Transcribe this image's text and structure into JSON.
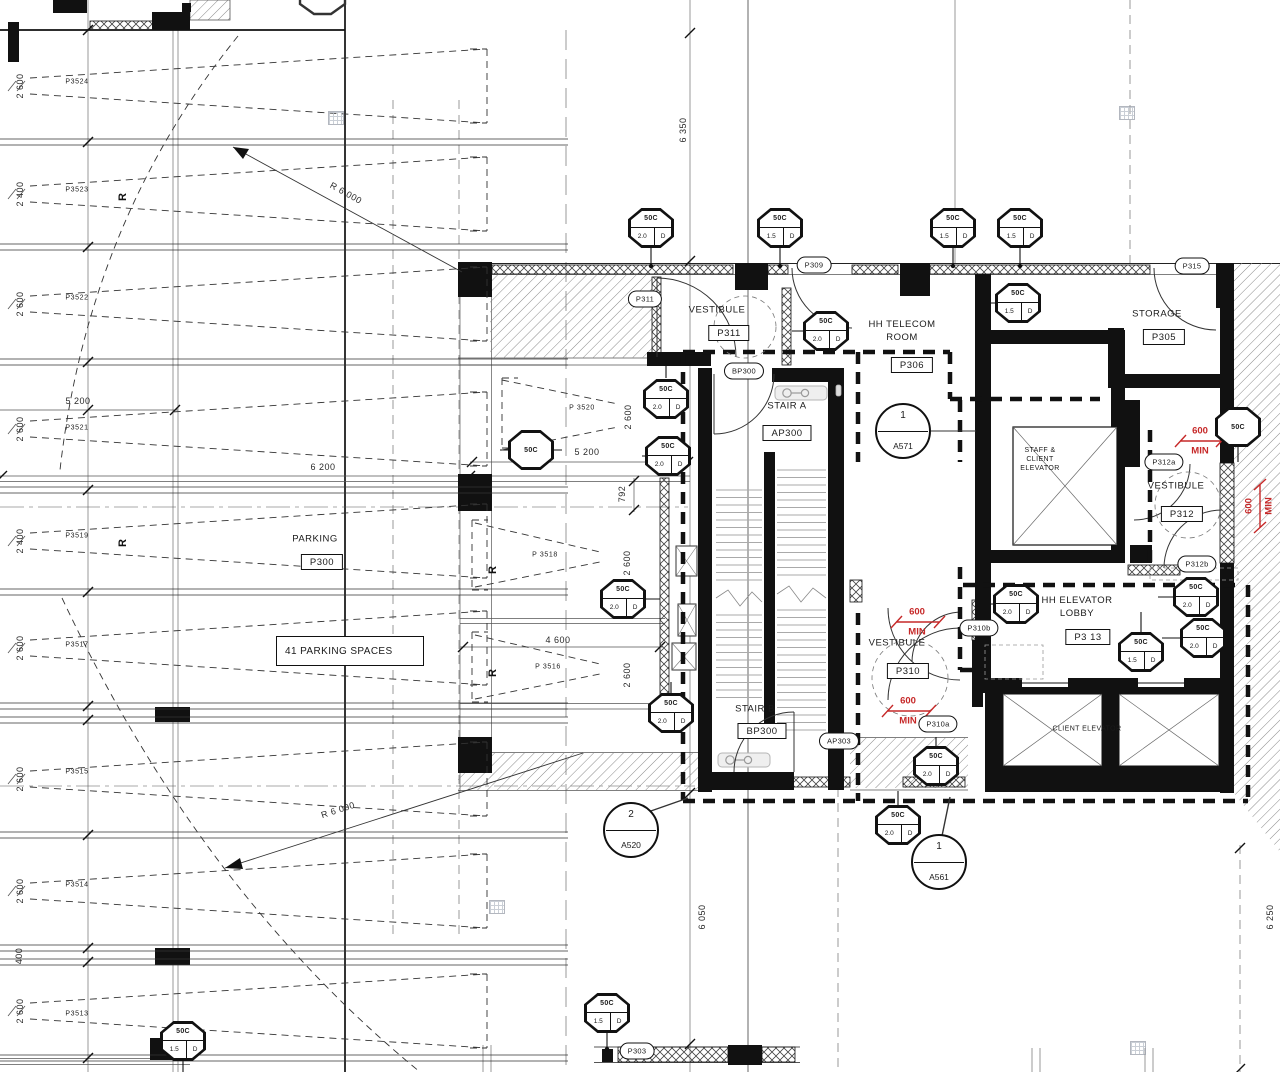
{
  "drawing": {
    "type": "parking-level-floor-plan",
    "red_accent": "#c62828"
  },
  "note": {
    "text": "41 PARKING SPACES"
  },
  "stalls": [
    {
      "label": "P3524",
      "dim": "2 600",
      "lx": 77,
      "ly": 82,
      "dx": 20,
      "dy": 86
    },
    {
      "label": "P3523",
      "dim": "2 400",
      "lx": 77,
      "ly": 190,
      "dx": 20,
      "dy": 194
    },
    {
      "label": "P3522",
      "dim": "2 600",
      "lx": 77,
      "ly": 298,
      "dx": 20,
      "dy": 304
    },
    {
      "label": "P3521",
      "dim": "2 600",
      "lx": 77,
      "ly": 428,
      "dx": 20,
      "dy": 429
    },
    {
      "label": "P3519",
      "dim": "2 400",
      "lx": 77,
      "ly": 536,
      "dx": 20,
      "dy": 541
    },
    {
      "label": "P3517",
      "dim": "2 600",
      "lx": 77,
      "ly": 645,
      "dx": 20,
      "dy": 648
    },
    {
      "label": "P3515",
      "dim": "2 600",
      "lx": 77,
      "ly": 772,
      "dx": 20,
      "dy": 779
    },
    {
      "label": "P3514",
      "dim": "2 600",
      "lx": 77,
      "ly": 885,
      "dx": 20,
      "dy": 891
    },
    {
      "label": "P3513",
      "dim": "2 600",
      "lx": 77,
      "ly": 1014,
      "dx": 20,
      "dy": 1011
    },
    {
      "label": "P 3520",
      "dim": "2 600",
      "lx": 582,
      "ly": 408,
      "dx": 628,
      "dy": 417
    },
    {
      "label": "P 3518",
      "dim": "2 600",
      "lx": 545,
      "ly": 555,
      "dx": 627,
      "dy": 563
    },
    {
      "label": "P 3516",
      "dim": "2 600",
      "lx": 548,
      "ly": 667,
      "dx": 627,
      "dy": 675
    }
  ],
  "dims": [
    {
      "t": "5 200",
      "x": 78,
      "y": 401,
      "r": 0
    },
    {
      "t": "6 200",
      "x": 323,
      "y": 467,
      "r": 0
    },
    {
      "t": "5 200",
      "x": 587,
      "y": 452,
      "r": 0
    },
    {
      "t": "4 600",
      "x": 558,
      "y": 640,
      "r": 0
    },
    {
      "t": "792",
      "x": 622,
      "y": 494,
      "r": -90
    },
    {
      "t": "400",
      "x": 19,
      "y": 956,
      "r": -90
    },
    {
      "t": "6 350",
      "x": 683,
      "y": 130,
      "r": -90
    },
    {
      "t": "6 050",
      "x": 702,
      "y": 917,
      "r": -90
    },
    {
      "t": "6 250",
      "x": 1270,
      "y": 917,
      "r": -90
    },
    {
      "t": "R 6 000",
      "x": 346,
      "y": 193,
      "r": 29
    },
    {
      "t": "R 6 000",
      "x": 338,
      "y": 810,
      "r": -18
    }
  ],
  "rooms": [
    {
      "lines": [
        "VESTIBULE"
      ],
      "number": "P311",
      "nx": 717,
      "ny": 311,
      "bx": 729,
      "by": 333
    },
    {
      "lines": [
        "HH TELECOM",
        "ROOM"
      ],
      "number": "P306",
      "nx": 902,
      "ny": 332,
      "bx": 912,
      "by": 365
    },
    {
      "lines": [
        "STORAGE"
      ],
      "number": "P305",
      "nx": 1157,
      "ny": 315,
      "bx": 1164,
      "by": 337
    },
    {
      "lines": [
        "STAIR A"
      ],
      "number": "AP300",
      "nx": 787,
      "ny": 407,
      "bx": 787,
      "by": 433
    },
    {
      "lines": [
        "STAIR B"
      ],
      "number": "BP300",
      "nx": 755,
      "ny": 710,
      "bx": 762,
      "by": 731
    },
    {
      "lines": [
        "HH ELEVATOR",
        "LOBBY"
      ],
      "number": "P3 13",
      "nx": 1077,
      "ny": 608,
      "bx": 1088,
      "by": 637
    },
    {
      "lines": [
        "VESTIBULE"
      ],
      "number": "P312",
      "nx": 1176,
      "ny": 487,
      "bx": 1182,
      "by": 514
    },
    {
      "lines": [
        "VESTIBULE"
      ],
      "number": "P310",
      "nx": 897,
      "ny": 644,
      "bx": 908,
      "by": 671
    },
    {
      "lines": [
        "PARKING"
      ],
      "number": "P300",
      "nx": 315,
      "ny": 540,
      "bx": 322,
      "by": 562
    },
    {
      "lines": [
        "STAFF &",
        "CLIENT",
        "ELEVATOR"
      ],
      "nx": 1040,
      "ny": 460,
      "small": true
    },
    {
      "lines": [
        "CLIENT ELEVATOR"
      ],
      "nx": 1087,
      "ny": 730,
      "small": true
    }
  ],
  "door_tags": [
    {
      "x": 651,
      "y": 228,
      "rating": "50C",
      "size": "2.0",
      "letter": "D"
    },
    {
      "x": 780,
      "y": 228,
      "rating": "50C",
      "size": "1.5",
      "letter": "D"
    },
    {
      "x": 953,
      "y": 228,
      "rating": "50C",
      "size": "1.5",
      "letter": "D"
    },
    {
      "x": 1020,
      "y": 228,
      "rating": "50C",
      "size": "1.5",
      "letter": "D"
    },
    {
      "x": 1018,
      "y": 303,
      "rating": "50C",
      "size": "1.5",
      "letter": "D"
    },
    {
      "x": 826,
      "y": 331,
      "rating": "50C",
      "size": "2.0",
      "letter": "D"
    },
    {
      "x": 666,
      "y": 399,
      "rating": "50C",
      "size": "2.0",
      "letter": "D"
    },
    {
      "x": 668,
      "y": 456,
      "rating": "50C",
      "size": "2.0",
      "letter": "D"
    },
    {
      "x": 531,
      "y": 450,
      "rating": "50C",
      "plain": true
    },
    {
      "x": 623,
      "y": 599,
      "rating": "50C",
      "size": "2.0",
      "letter": "D"
    },
    {
      "x": 1238,
      "y": 427,
      "rating": "50C",
      "plain": true
    },
    {
      "x": 1016,
      "y": 604,
      "rating": "50C",
      "size": "2.0",
      "letter": "D"
    },
    {
      "x": 1141,
      "y": 652,
      "rating": "50C",
      "size": "1.5",
      "letter": "D"
    },
    {
      "x": 1196,
      "y": 597,
      "rating": "50C",
      "size": "2.0",
      "letter": "D"
    },
    {
      "x": 1203,
      "y": 638,
      "rating": "50C",
      "size": "2.0",
      "letter": "D"
    },
    {
      "x": 671,
      "y": 713,
      "rating": "50C",
      "size": "2.0",
      "letter": "D"
    },
    {
      "x": 936,
      "y": 766,
      "rating": "50C",
      "size": "2.0",
      "letter": "D"
    },
    {
      "x": 898,
      "y": 825,
      "rating": "50C",
      "size": "2.0",
      "letter": "D"
    },
    {
      "x": 607,
      "y": 1013,
      "rating": "50C",
      "size": "1.5",
      "letter": "D"
    },
    {
      "x": 183,
      "y": 1041,
      "rating": "50C",
      "size": "1.5",
      "letter": "D"
    }
  ],
  "ovals": [
    {
      "label": "P311",
      "x": 645,
      "y": 299
    },
    {
      "label": "P309",
      "x": 814,
      "y": 265
    },
    {
      "label": "BP300",
      "x": 744,
      "y": 371
    },
    {
      "label": "P315",
      "x": 1192,
      "y": 266
    },
    {
      "label": "P312a",
      "x": 1164,
      "y": 462
    },
    {
      "label": "P312b",
      "x": 1197,
      "y": 564
    },
    {
      "label": "P310b",
      "x": 979,
      "y": 628
    },
    {
      "label": "P310a",
      "x": 938,
      "y": 724
    },
    {
      "label": "AP303",
      "x": 839,
      "y": 741
    },
    {
      "label": "P303",
      "x": 637,
      "y": 1051
    }
  ],
  "markers": [
    {
      "number": "1",
      "sheet": "A571",
      "x": 903,
      "y": 431
    },
    {
      "number": "2",
      "sheet": "A520",
      "x": 631,
      "y": 830
    },
    {
      "number": "1",
      "sheet": "A561",
      "x": 939,
      "y": 862
    }
  ],
  "clearances": [
    {
      "value": "600",
      "unit": "MIN",
      "x": 917,
      "y": 622,
      "vertical": false
    },
    {
      "value": "600",
      "unit": "MIN",
      "x": 908,
      "y": 711,
      "vertical": false
    },
    {
      "value": "600",
      "unit": "MIN",
      "x": 1200,
      "y": 441,
      "vertical": false
    },
    {
      "value": "600",
      "unit": "MIN",
      "x": 1259,
      "y": 506,
      "vertical": true
    }
  ],
  "r_markers": [
    {
      "label": "R",
      "x": 123,
      "y": 197
    },
    {
      "label": "R",
      "x": 123,
      "y": 543
    },
    {
      "label": "R",
      "x": 493,
      "y": 570
    },
    {
      "label": "R",
      "x": 493,
      "y": 673
    }
  ],
  "symbols": [
    {
      "x": 336,
      "y": 118
    },
    {
      "x": 1127,
      "y": 113
    },
    {
      "x": 497,
      "y": 907
    },
    {
      "x": 1138,
      "y": 1048
    }
  ]
}
